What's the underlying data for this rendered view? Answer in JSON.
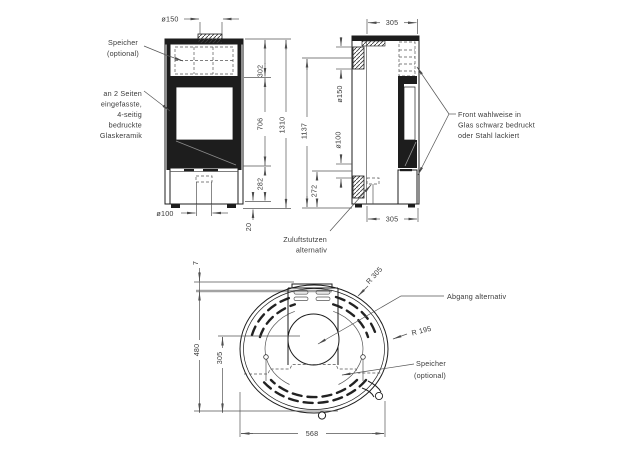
{
  "front_view": {
    "dims": {
      "flue_diameter": "ø150",
      "top_section": "302",
      "middle_section": "706",
      "total_height": "1310",
      "base_section": "282",
      "foot_height": "20",
      "inlet_diameter": "ø100"
    },
    "notes": {
      "speicher_line1": "Speicher",
      "speicher_line2": "(optional)",
      "glass_line1": "an 2 Seiten",
      "glass_line2": "eingefasste,",
      "glass_line3": "4-seitig",
      "glass_line4": "bedruckte",
      "glass_line5": "Glaskeramik"
    }
  },
  "side_view": {
    "dims": {
      "top_depth": "305",
      "rear_flue_diameter": "ø150",
      "flue_height": "1137",
      "rear_inlet_diameter": "ø100",
      "inlet_height": "272",
      "bottom_depth": "305"
    },
    "notes": {
      "front_line1": "Front wahlweise in",
      "front_line2": "Glas schwarz bedruckt",
      "front_line3": "oder Stahl lackiert",
      "zuluft_line1": "Zuluftstutzen",
      "zuluft_line2": "alternativ"
    }
  },
  "top_view": {
    "dims": {
      "wall_gap": "7",
      "depth": "480",
      "flue_center": "305",
      "width": "568",
      "outer_radius": "R 305",
      "inner_radius": "R 195"
    },
    "notes": {
      "abgang": "Abgang alternativ",
      "speicher_line1": "Speicher",
      "speicher_line2": "(optional)"
    }
  }
}
